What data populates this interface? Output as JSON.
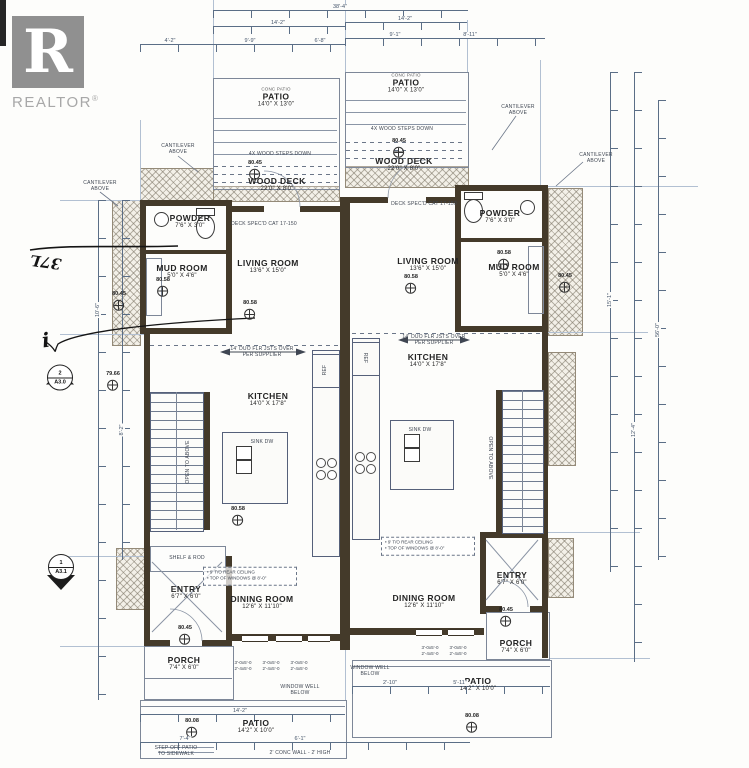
{
  "logo": {
    "letter": "R",
    "brand": "REALTOR",
    "registered": "®"
  },
  "plan": {
    "rooms": [
      {
        "id": "patio-a-top",
        "note": "CONC PATIO",
        "label": "PATIO",
        "dims": "14'0\" X 13'0\"",
        "x": 276,
        "y": 97
      },
      {
        "id": "wood-deck-a",
        "label": "WOOD DECK",
        "dims": "22'0\" X 8'0\"",
        "x": 277,
        "y": 184
      },
      {
        "id": "powder-a",
        "label": "POWDER",
        "dims": "7'6\" X 3'0\"",
        "x": 190,
        "y": 221
      },
      {
        "id": "mud-room-a",
        "label": "MUD ROOM",
        "dims": "5'0\" X 4'6\"",
        "x": 182,
        "y": 271
      },
      {
        "id": "living-room-a",
        "label": "LIVING ROOM",
        "dims": "13'6\" X 15'0\"",
        "x": 268,
        "y": 266
      },
      {
        "id": "kitchen-a",
        "label": "KITCHEN",
        "dims": "14'0\" X 17'8\"",
        "x": 268,
        "y": 399
      },
      {
        "id": "entry-a",
        "label": "ENTRY",
        "dims": "6'7\" X 6'0\"",
        "x": 186,
        "y": 592
      },
      {
        "id": "dining-room-a",
        "label": "DINING ROOM",
        "dims": "12'6\" X 11'10\"",
        "x": 262,
        "y": 602
      },
      {
        "id": "porch-a",
        "label": "PORCH",
        "dims": "7'4\" X 6'0\"",
        "x": 184,
        "y": 663
      },
      {
        "id": "patio-a-bottom",
        "label": "PATIO",
        "dims": "14'2\" X 10'0\"",
        "x": 256,
        "y": 726
      },
      {
        "id": "patio-b-top",
        "note": "CONC PATIO",
        "label": "PATIO",
        "dims": "14'0\" X 13'0\"",
        "x": 406,
        "y": 83
      },
      {
        "id": "wood-deck-b",
        "label": "WOOD DECK",
        "dims": "22'0\" X 8'0\"",
        "x": 404,
        "y": 164
      },
      {
        "id": "powder-b",
        "label": "POWDER",
        "dims": "7'6\" X 3'0\"",
        "x": 500,
        "y": 216
      },
      {
        "id": "mud-room-b",
        "label": "MUD ROOM",
        "dims": "5'0\" X 4'6\"",
        "x": 514,
        "y": 270
      },
      {
        "id": "living-room-b",
        "label": "LIVING ROOM",
        "dims": "13'6\" X 15'0\"",
        "x": 428,
        "y": 264
      },
      {
        "id": "kitchen-b",
        "label": "KITCHEN",
        "dims": "14'0\" X 17'8\"",
        "x": 428,
        "y": 360
      },
      {
        "id": "dining-room-b",
        "label": "DINING ROOM",
        "dims": "12'6\" X 11'10\"",
        "x": 424,
        "y": 601
      },
      {
        "id": "entry-b",
        "label": "ENTRY",
        "dims": "6'7\" X 6'0\"",
        "x": 512,
        "y": 578
      },
      {
        "id": "porch-b",
        "label": "PORCH",
        "dims": "7'4\" X 6'0\"",
        "x": 516,
        "y": 646
      },
      {
        "id": "patio-b-bottom",
        "label": "PATIO",
        "dims": "14'2\" X 10'0\"",
        "x": 478,
        "y": 684
      }
    ],
    "elevation_markers": [
      {
        "value": "80.45",
        "x": 255,
        "y": 172
      },
      {
        "value": "80.45",
        "x": 399,
        "y": 150
      },
      {
        "value": "80.45",
        "x": 119,
        "y": 303
      },
      {
        "value": "80.58",
        "x": 163,
        "y": 289
      },
      {
        "value": "80.58",
        "x": 250,
        "y": 312
      },
      {
        "value": "80.58",
        "x": 411,
        "y": 286
      },
      {
        "value": "80.58",
        "x": 504,
        "y": 262
      },
      {
        "value": "79.66",
        "x": 113,
        "y": 383
      },
      {
        "value": "80.58",
        "x": 238,
        "y": 518
      },
      {
        "value": "80.45",
        "x": 565,
        "y": 285
      },
      {
        "value": "80.45",
        "x": 185,
        "y": 637
      },
      {
        "value": "80.45",
        "x": 506,
        "y": 619
      },
      {
        "value": "80.08",
        "x": 192,
        "y": 730
      },
      {
        "value": "80.08",
        "x": 472,
        "y": 725
      }
    ],
    "section_markers": [
      {
        "number": "2",
        "sheet": "A3.0",
        "dir": "up",
        "x": 60,
        "y": 380
      },
      {
        "number": "1",
        "sheet": "A3.1",
        "dir": "down",
        "x": 61,
        "y": 572
      }
    ],
    "annotations": [
      {
        "text": "CANTILEVER\nABOVE",
        "x": 178,
        "y": 149
      },
      {
        "text": "CANTILEVER\nABOVE",
        "x": 100,
        "y": 186
      },
      {
        "text": "CANTILEVER\nABOVE",
        "x": 518,
        "y": 110
      },
      {
        "text": "CANTILEVER\nABOVE",
        "x": 596,
        "y": 158
      },
      {
        "text": "4X WOOD STEPS DOWN",
        "x": 280,
        "y": 154
      },
      {
        "text": "4X WOOD STEPS DOWN",
        "x": 402,
        "y": 129
      },
      {
        "text": "DECK SPEC'D CAT 17-150",
        "x": 264,
        "y": 224
      },
      {
        "text": "DECK SPEC'D CAT 17-150",
        "x": 424,
        "y": 204
      },
      {
        "text": "14' DUO FLR JSTS OVER\nPER SUPPLIER",
        "x": 262,
        "y": 352
      },
      {
        "text": "14' DUO FLR JSTS OVER\nPER SUPPLIER",
        "x": 434,
        "y": 340
      },
      {
        "text": "OPEN TO ABOVE",
        "x": 188,
        "y": 462,
        "rot": -90
      },
      {
        "text": "OPEN TO ABOVE",
        "x": 490,
        "y": 458,
        "rot": 90
      },
      {
        "text": "WINDOW WELL\nBELOW",
        "x": 300,
        "y": 690
      },
      {
        "text": "WINDOW WELL\nBELOW",
        "x": 370,
        "y": 671
      },
      {
        "text": "STEP OFF PATIO\nTO SIDEWALK",
        "x": 176,
        "y": 751
      },
      {
        "text": "2' CONC WALL - 2' HIGH",
        "x": 300,
        "y": 753
      },
      {
        "text": "SINK DW",
        "x": 262,
        "y": 442
      },
      {
        "text": "SINK DW",
        "x": 420,
        "y": 430
      },
      {
        "text": "REF",
        "x": 325,
        "y": 370,
        "rot": -90
      },
      {
        "text": "REF",
        "x": 365,
        "y": 358,
        "rot": 90
      },
      {
        "text": "SHELF & ROD",
        "x": 187,
        "y": 558
      }
    ],
    "note_boxes": [
      {
        "lines": [
          "9' T/O REAR CEILING",
          "TOP OF WINDOWS @ 8'-0\""
        ],
        "x": 250,
        "y": 576,
        "w": 86
      },
      {
        "lines": [
          "9' T/O REAR CEILING",
          "TOP OF WINDOWS @ 8'-0\""
        ],
        "x": 428,
        "y": 546,
        "w": 86
      }
    ],
    "window_tags": [
      {
        "text": "3'-0x5'-0\n2'-4x5'-0",
        "x": 243,
        "y": 660
      },
      {
        "text": "3'-0x5'-0\n2'-4x5'-0",
        "x": 271,
        "y": 660
      },
      {
        "text": "3'-0x5'-0\n2'-4x5'-0",
        "x": 299,
        "y": 660
      },
      {
        "text": "3'-0x5'-0\n2'-4x5'-0",
        "x": 430,
        "y": 645
      },
      {
        "text": "3'-0x5'-0\n2'-4x5'-0",
        "x": 458,
        "y": 645
      }
    ],
    "dim_labels": [
      {
        "text": "38'-4\"",
        "x": 340,
        "y": 7
      },
      {
        "text": "14'-2\"",
        "x": 278,
        "y": 23
      },
      {
        "text": "14'-2\"",
        "x": 405,
        "y": 19
      },
      {
        "text": "4'-2\"",
        "x": 170,
        "y": 41
      },
      {
        "text": "9'-9\"",
        "x": 250,
        "y": 41
      },
      {
        "text": "6'-8\"",
        "x": 320,
        "y": 41
      },
      {
        "text": "9'-1\"",
        "x": 395,
        "y": 35
      },
      {
        "text": "8'-11\"",
        "x": 470,
        "y": 35
      },
      {
        "text": "15'-1\"",
        "x": 610,
        "y": 300,
        "rot": -90
      },
      {
        "text": "12'-4\"",
        "x": 634,
        "y": 430,
        "rot": -90
      },
      {
        "text": "56'-0\"",
        "x": 658,
        "y": 330,
        "rot": -90
      },
      {
        "text": "10'-6\"",
        "x": 98,
        "y": 310,
        "rot": -90
      },
      {
        "text": "8'-2\"",
        "x": 122,
        "y": 430,
        "rot": -90
      },
      {
        "text": "14'-2\"",
        "x": 240,
        "y": 711
      },
      {
        "text": "7'-4\"",
        "x": 185,
        "y": 739
      },
      {
        "text": "6'-1\"",
        "x": 300,
        "y": 739
      },
      {
        "text": "2'-10\"",
        "x": 390,
        "y": 683
      },
      {
        "text": "5'-11\"",
        "x": 460,
        "y": 683
      }
    ],
    "handwriting": [
      {
        "text": "37L",
        "x": 30,
        "y": 253,
        "rot": 188,
        "size": 15
      },
      {
        "text": "i",
        "x": 42,
        "y": 328,
        "rot": -8,
        "size": 20
      }
    ]
  }
}
